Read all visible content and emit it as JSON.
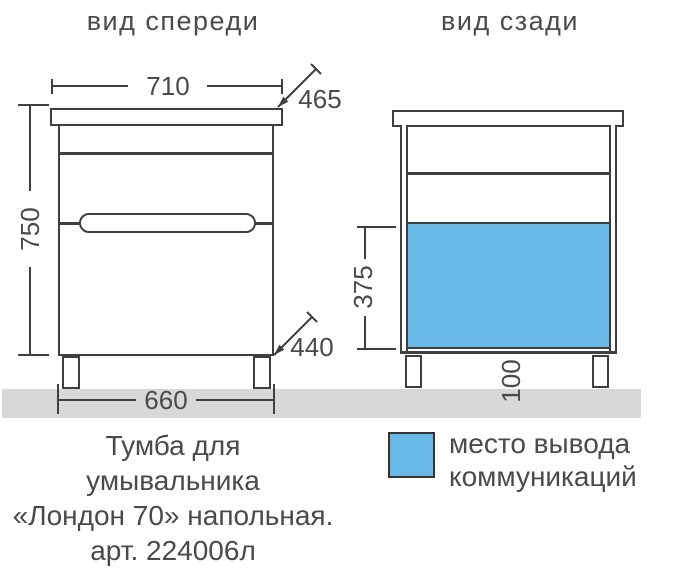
{
  "titles": {
    "front": "вид спереди",
    "back": "вид сзади"
  },
  "dims": {
    "top_width": "710",
    "top_depth": "465",
    "height": "750",
    "bottom_depth": "440",
    "bottom_width": "660",
    "cutout_height": "375",
    "leg_height": "100"
  },
  "legend": {
    "line1": "место вывода",
    "line2": "коммуникаций"
  },
  "caption": {
    "line1": "Тумба для",
    "line2": "умывальника",
    "line3": "«Лондон 70» напольная.",
    "line4": "арт. 224006л"
  },
  "colors": {
    "line": "#3f3f3f",
    "text": "#4a4a4a",
    "blue": "#67b8e6",
    "floor": "#d8d8d8"
  }
}
